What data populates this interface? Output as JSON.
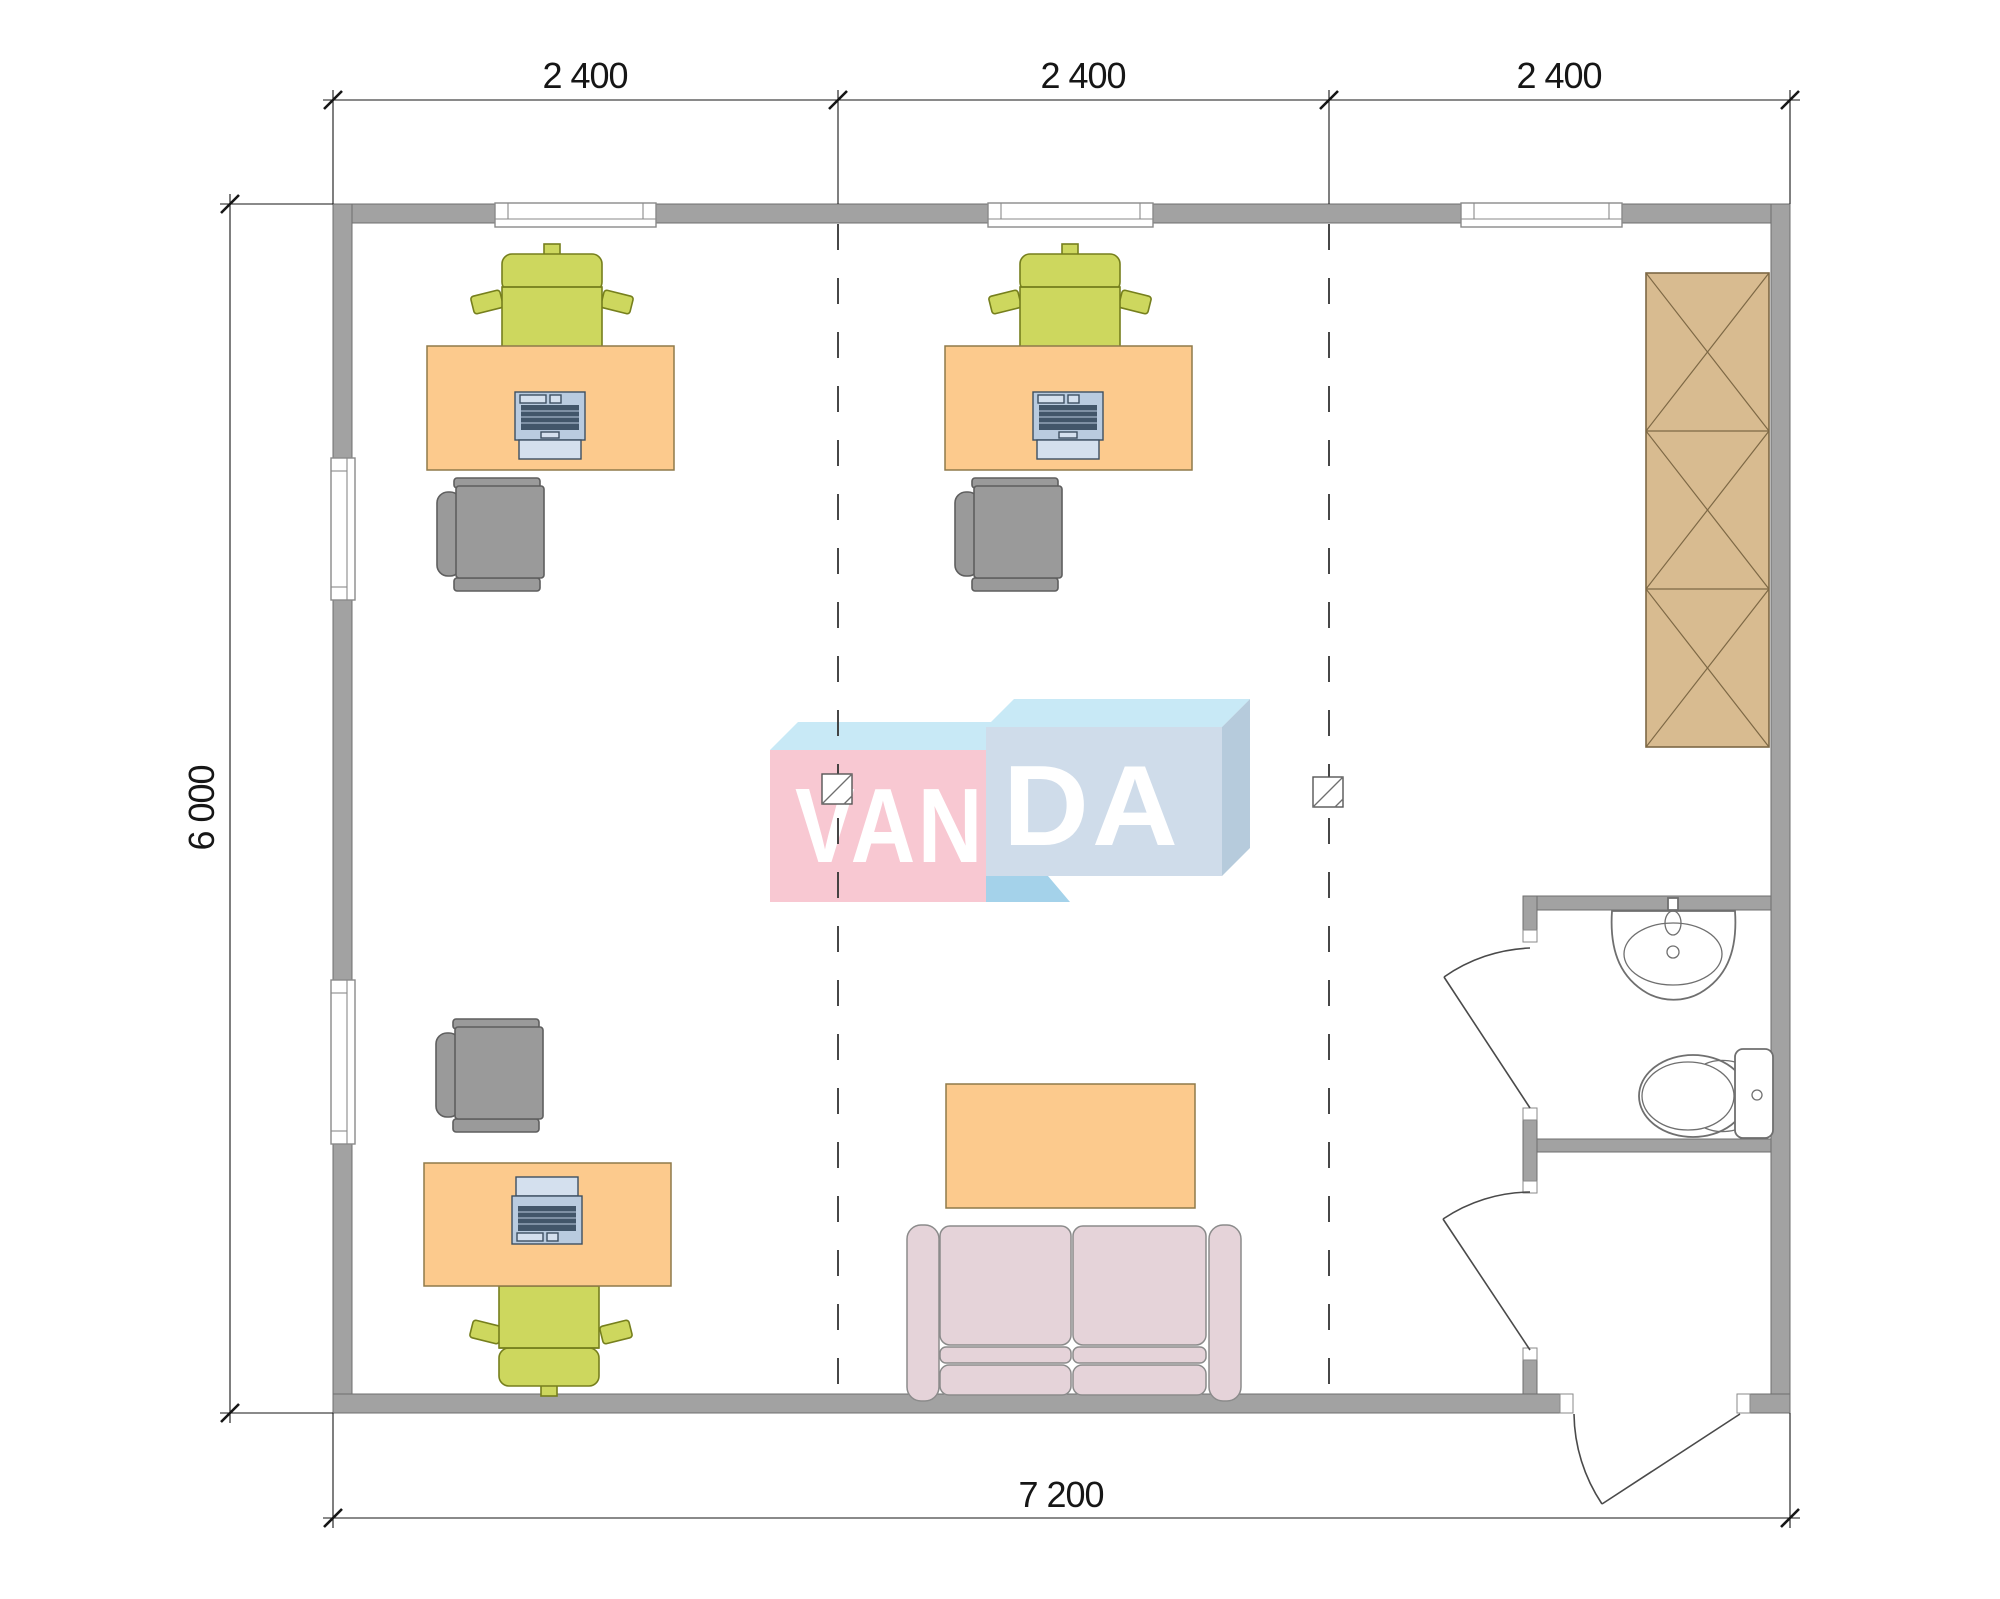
{
  "drawing": {
    "kind": "office floor plan",
    "watermark": "VANDA"
  },
  "dimensions": {
    "top": [
      "2 400",
      "2 400",
      "2 400"
    ],
    "left": "6 000",
    "bottom": "7 200"
  },
  "logo": {
    "left": "VAN",
    "right": "DA"
  },
  "colors": {
    "wall": "#a2a2a2",
    "wallLine": "#6f6f6f",
    "windowLine": "#8a8a8a",
    "dim": "#161616",
    "dash": "#333333",
    "desk": "#fcca8d",
    "deskLine": "#8f7a4a",
    "chairGreen": "#cdd75e",
    "chairGreenLine": "#767f1d",
    "chairGray": "#9a9a9a",
    "chairGrayLine": "#5e5e5e",
    "laptopBody": "#b9cbdf",
    "laptopDark": "#42566a",
    "laptopScreen": "#d4e0ee",
    "laptopLine": "#3c4f61",
    "wardrobe": "#d8bb90",
    "wardrobeLine": "#7d6845",
    "sofa": "#e5d3d9",
    "sofaLine": "#8b8b8b",
    "fixture": "#6f6f6f",
    "logoPink": "#f8c8d2",
    "logoBlue": "#cfdcea",
    "logoTop": "#c8e9f6",
    "logoSide": "#b6cbdc",
    "logoAccent": "#a4d2ea",
    "logoText": "#ffffff"
  }
}
